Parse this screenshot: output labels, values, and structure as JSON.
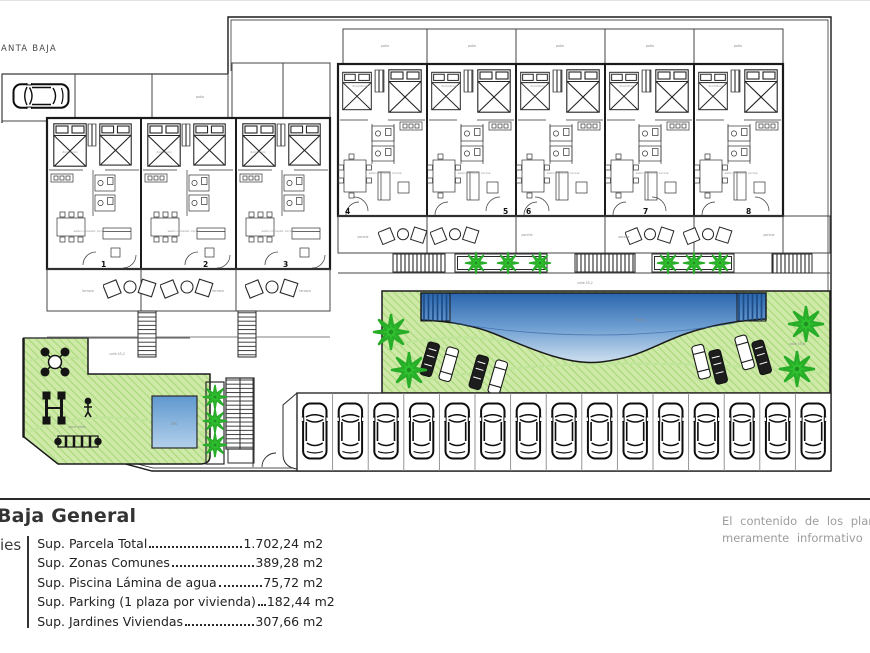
{
  "plan": {
    "title": "ANTA BAJA",
    "unit_numbers": [
      "1",
      "2",
      "3",
      "4",
      "5",
      "6",
      "7",
      "8"
    ],
    "room_labels": {
      "salon": "salón comedor cocina",
      "dormitorio": "dormitorio",
      "patio": "patio",
      "terraza": "terraza",
      "porche": "porche"
    },
    "tiny_labels": [
      "patio",
      "patio",
      "patio",
      "patio",
      "patio",
      "patio",
      "terraza",
      "terraza",
      "terraza",
      "porche",
      "porche",
      "porche",
      "porche",
      "calle 45,2",
      "calle 45,2",
      "calle 45,6",
      "Piscina",
      "SPA",
      "zona niños"
    ],
    "parking": {
      "car_count": 15
    },
    "colors": {
      "garden_green": "#cfeaa8",
      "garden_hatch": "#a9d97c",
      "palm_green": "#2fc12f",
      "pool_deep": "#2a66ae",
      "pool_mid": "#6f9fd2",
      "pool_shallow": "#cfe0ef",
      "wall": "#1b1b1b",
      "gray_text": "#9d9d9d"
    }
  },
  "legend": {
    "title": "Baja General",
    "side_label": "ies",
    "rows": [
      {
        "label": "Sup. Parcela Total",
        "value": "1.702,24 m2"
      },
      {
        "label": "Sup. Zonas Comunes",
        "value": "389,28 m2"
      },
      {
        "label": "Sup. Piscina Lámina de agua",
        "value": "75,72 m2"
      },
      {
        "label": "Sup. Parking (1 plaza por vivienda)",
        "value": "182,44 m2"
      },
      {
        "label": "Sup. Jardines Viviendas",
        "value": "307,66 m2"
      }
    ],
    "disclaimer_line1": "El contenido de los planos",
    "disclaimer_line2": "meramente informativo y n"
  }
}
